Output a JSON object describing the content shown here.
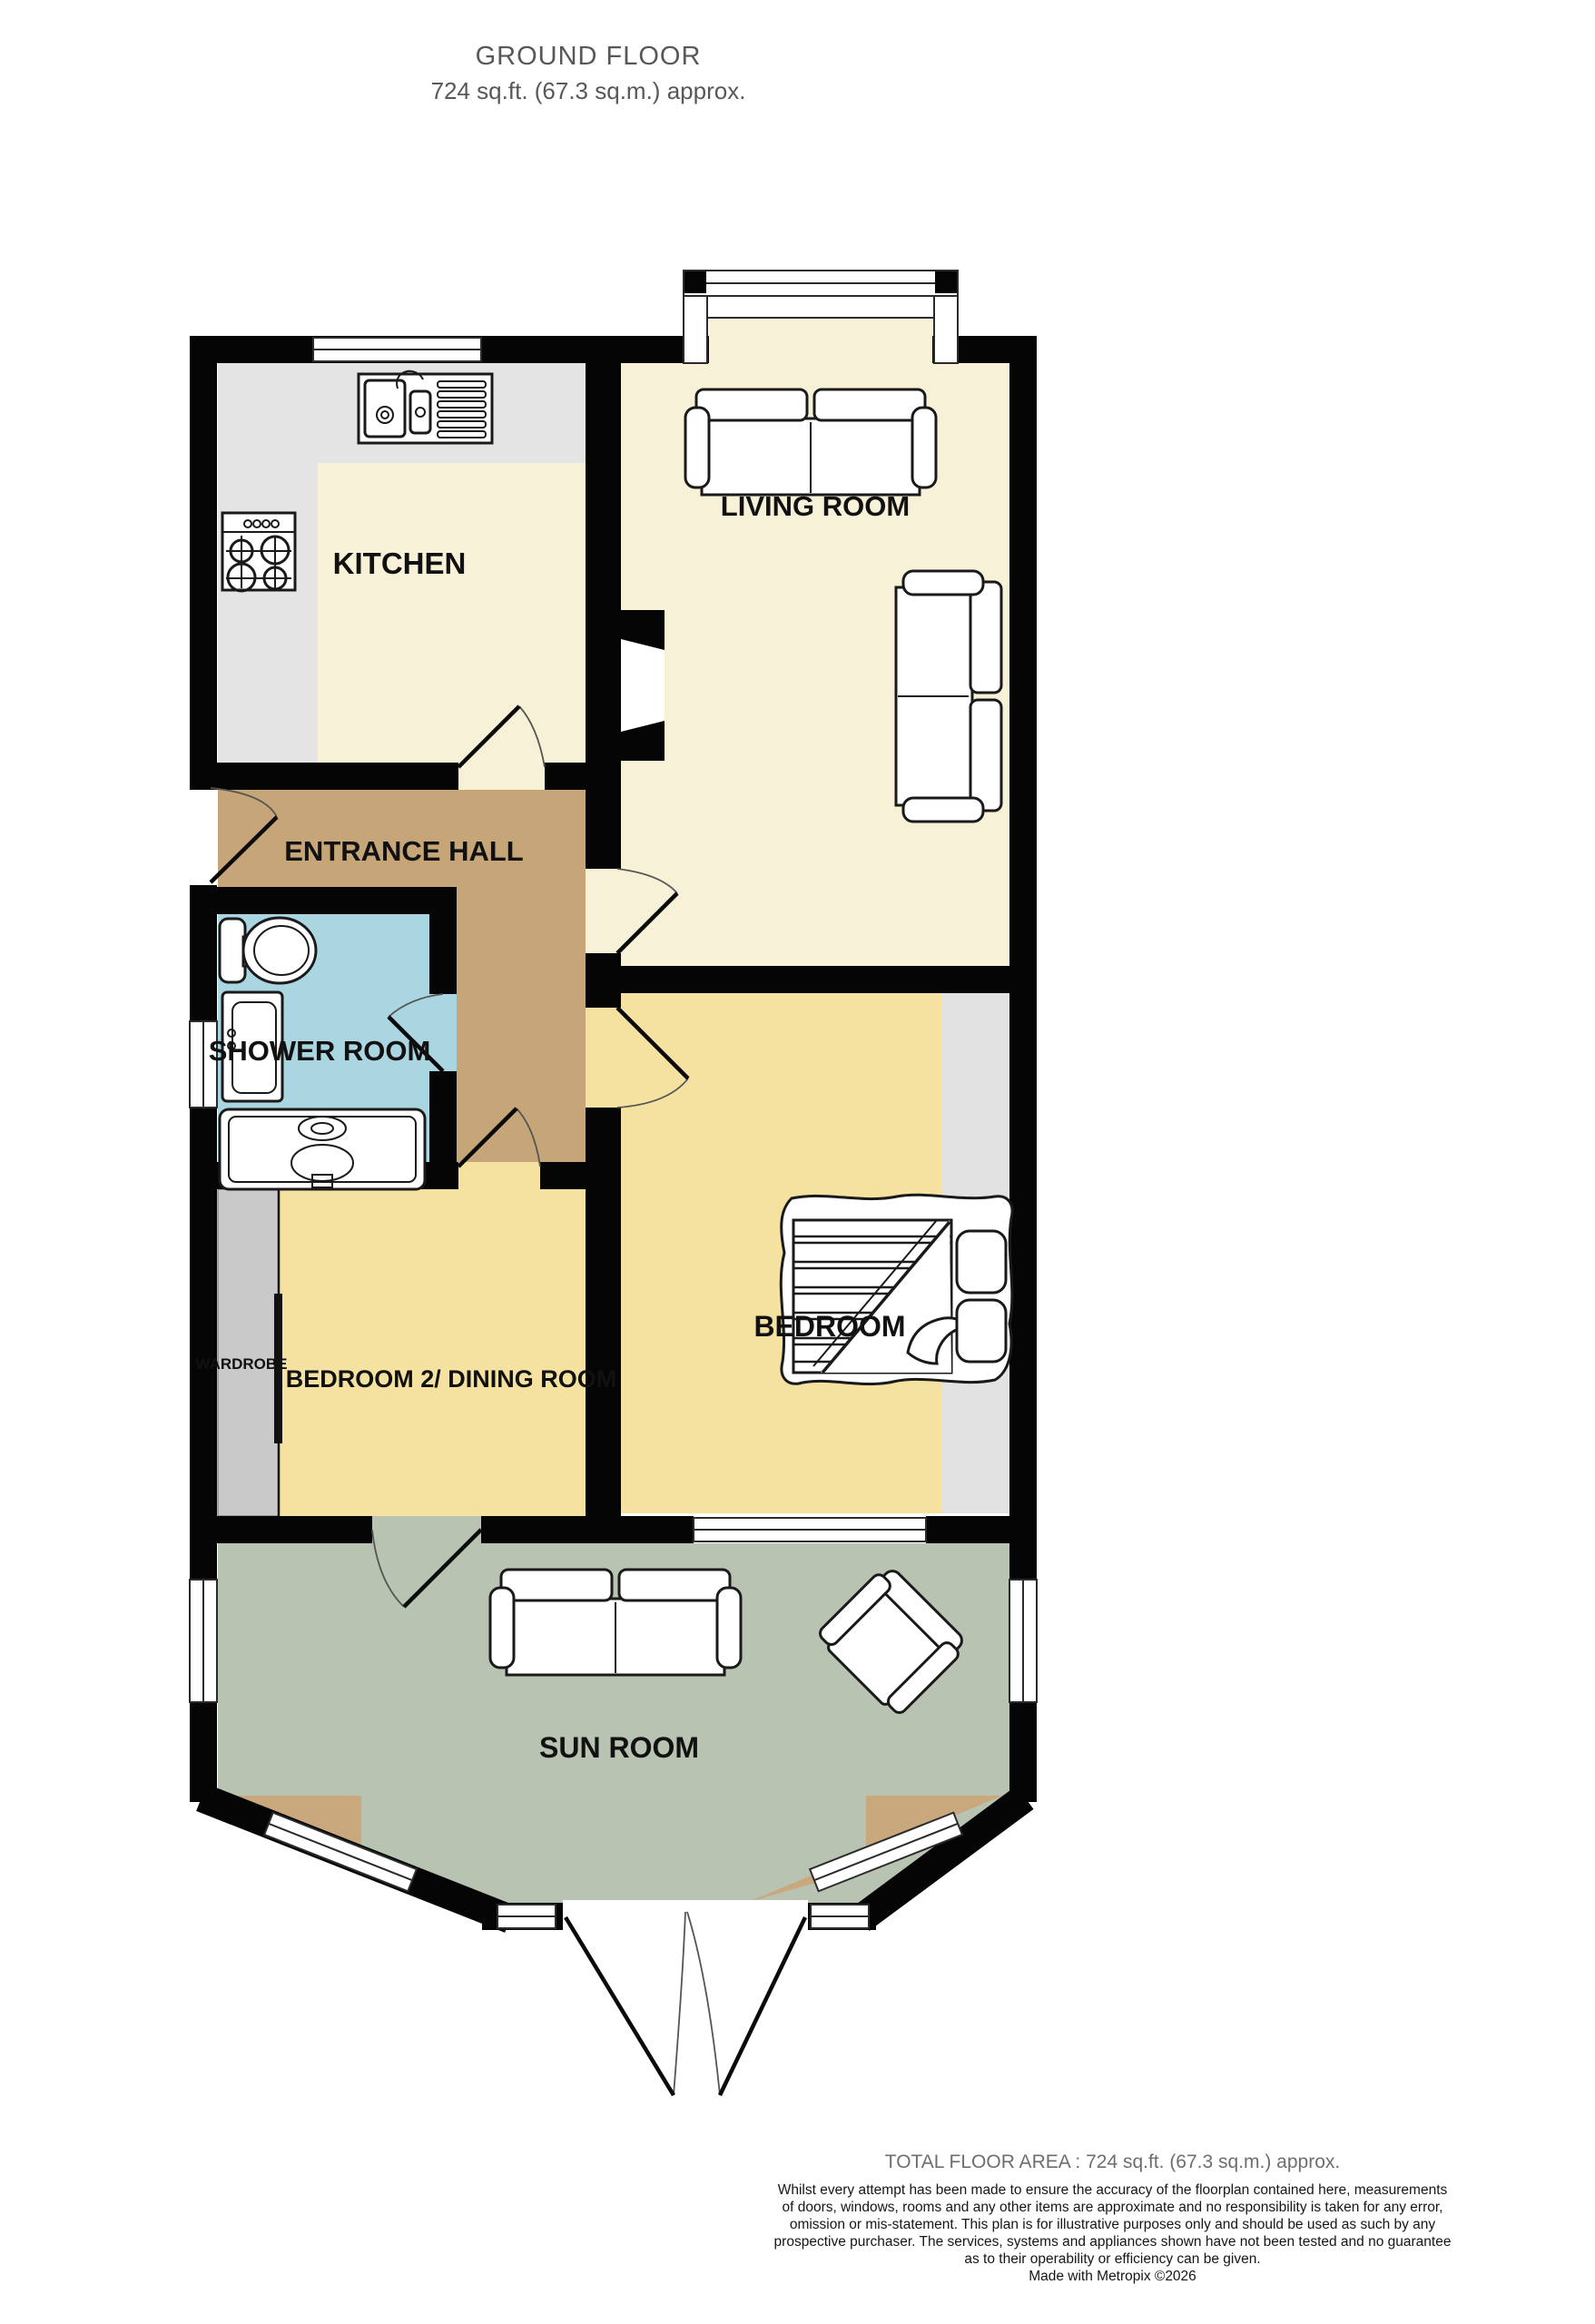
{
  "title": {
    "line1": "GROUND FLOOR",
    "line2": "724 sq.ft. (67.3 sq.m.) approx."
  },
  "rooms": {
    "kitchen": {
      "label": "KITCHEN"
    },
    "living_room": {
      "label": "LIVING ROOM"
    },
    "entrance_hall": {
      "label": "ENTRANCE HALL"
    },
    "shower_room": {
      "label": "SHOWER ROOM"
    },
    "bedroom2_dining": {
      "label": "BEDROOM 2/ DINING ROOM"
    },
    "bedroom": {
      "label": "BEDROOM"
    },
    "sun_room": {
      "label": "SUN ROOM"
    },
    "wardrobe": {
      "label": "WARDROBE"
    }
  },
  "fixtures": [
    "kitchen-sink-icon",
    "cooktop-icon",
    "sofa-icon",
    "sofa-icon",
    "sofa-icon",
    "double-bed-icon",
    "toilet-icon",
    "shower-enclosure-icon",
    "wash-basin-icon",
    "armchair-icon",
    "wardrobe-strip",
    "bay-window",
    "french-doors"
  ],
  "colors": {
    "wall": "#050505",
    "floor_cream": "#f7f1d8",
    "floor_counter_gray": "#e4e4e4",
    "floor_hall_brown": "#c6a578",
    "floor_shower_blue": "#aad6e2",
    "floor_bedroom_yellow": "#f5e2a0",
    "floor_sunroom_sage": "#b9c3b2",
    "sunroom_corner_tan": "#c9a87e",
    "wardrobe_gray": "#c9c9c9",
    "bedroom_strip_gray": "#e2e2e2",
    "title_gray": "#57585a",
    "footer_gray": "#6d6e70"
  },
  "footer": {
    "total_area": "TOTAL FLOOR AREA : 724 sq.ft. (67.3 sq.m.) approx.",
    "disclaimer_lines": [
      "Whilst every attempt has been made to ensure the accuracy of the floorplan contained here, measurements",
      "of doors, windows, rooms and any other items are approximate and no responsibility is taken for any error,",
      "omission or mis-statement. This plan is for illustrative purposes only and should be used as such by any",
      "prospective purchaser. The services, systems and appliances shown have not been tested and no guarantee",
      "as to their operability or efficiency can be given."
    ],
    "credit": "Made with Metropix ©2026"
  }
}
